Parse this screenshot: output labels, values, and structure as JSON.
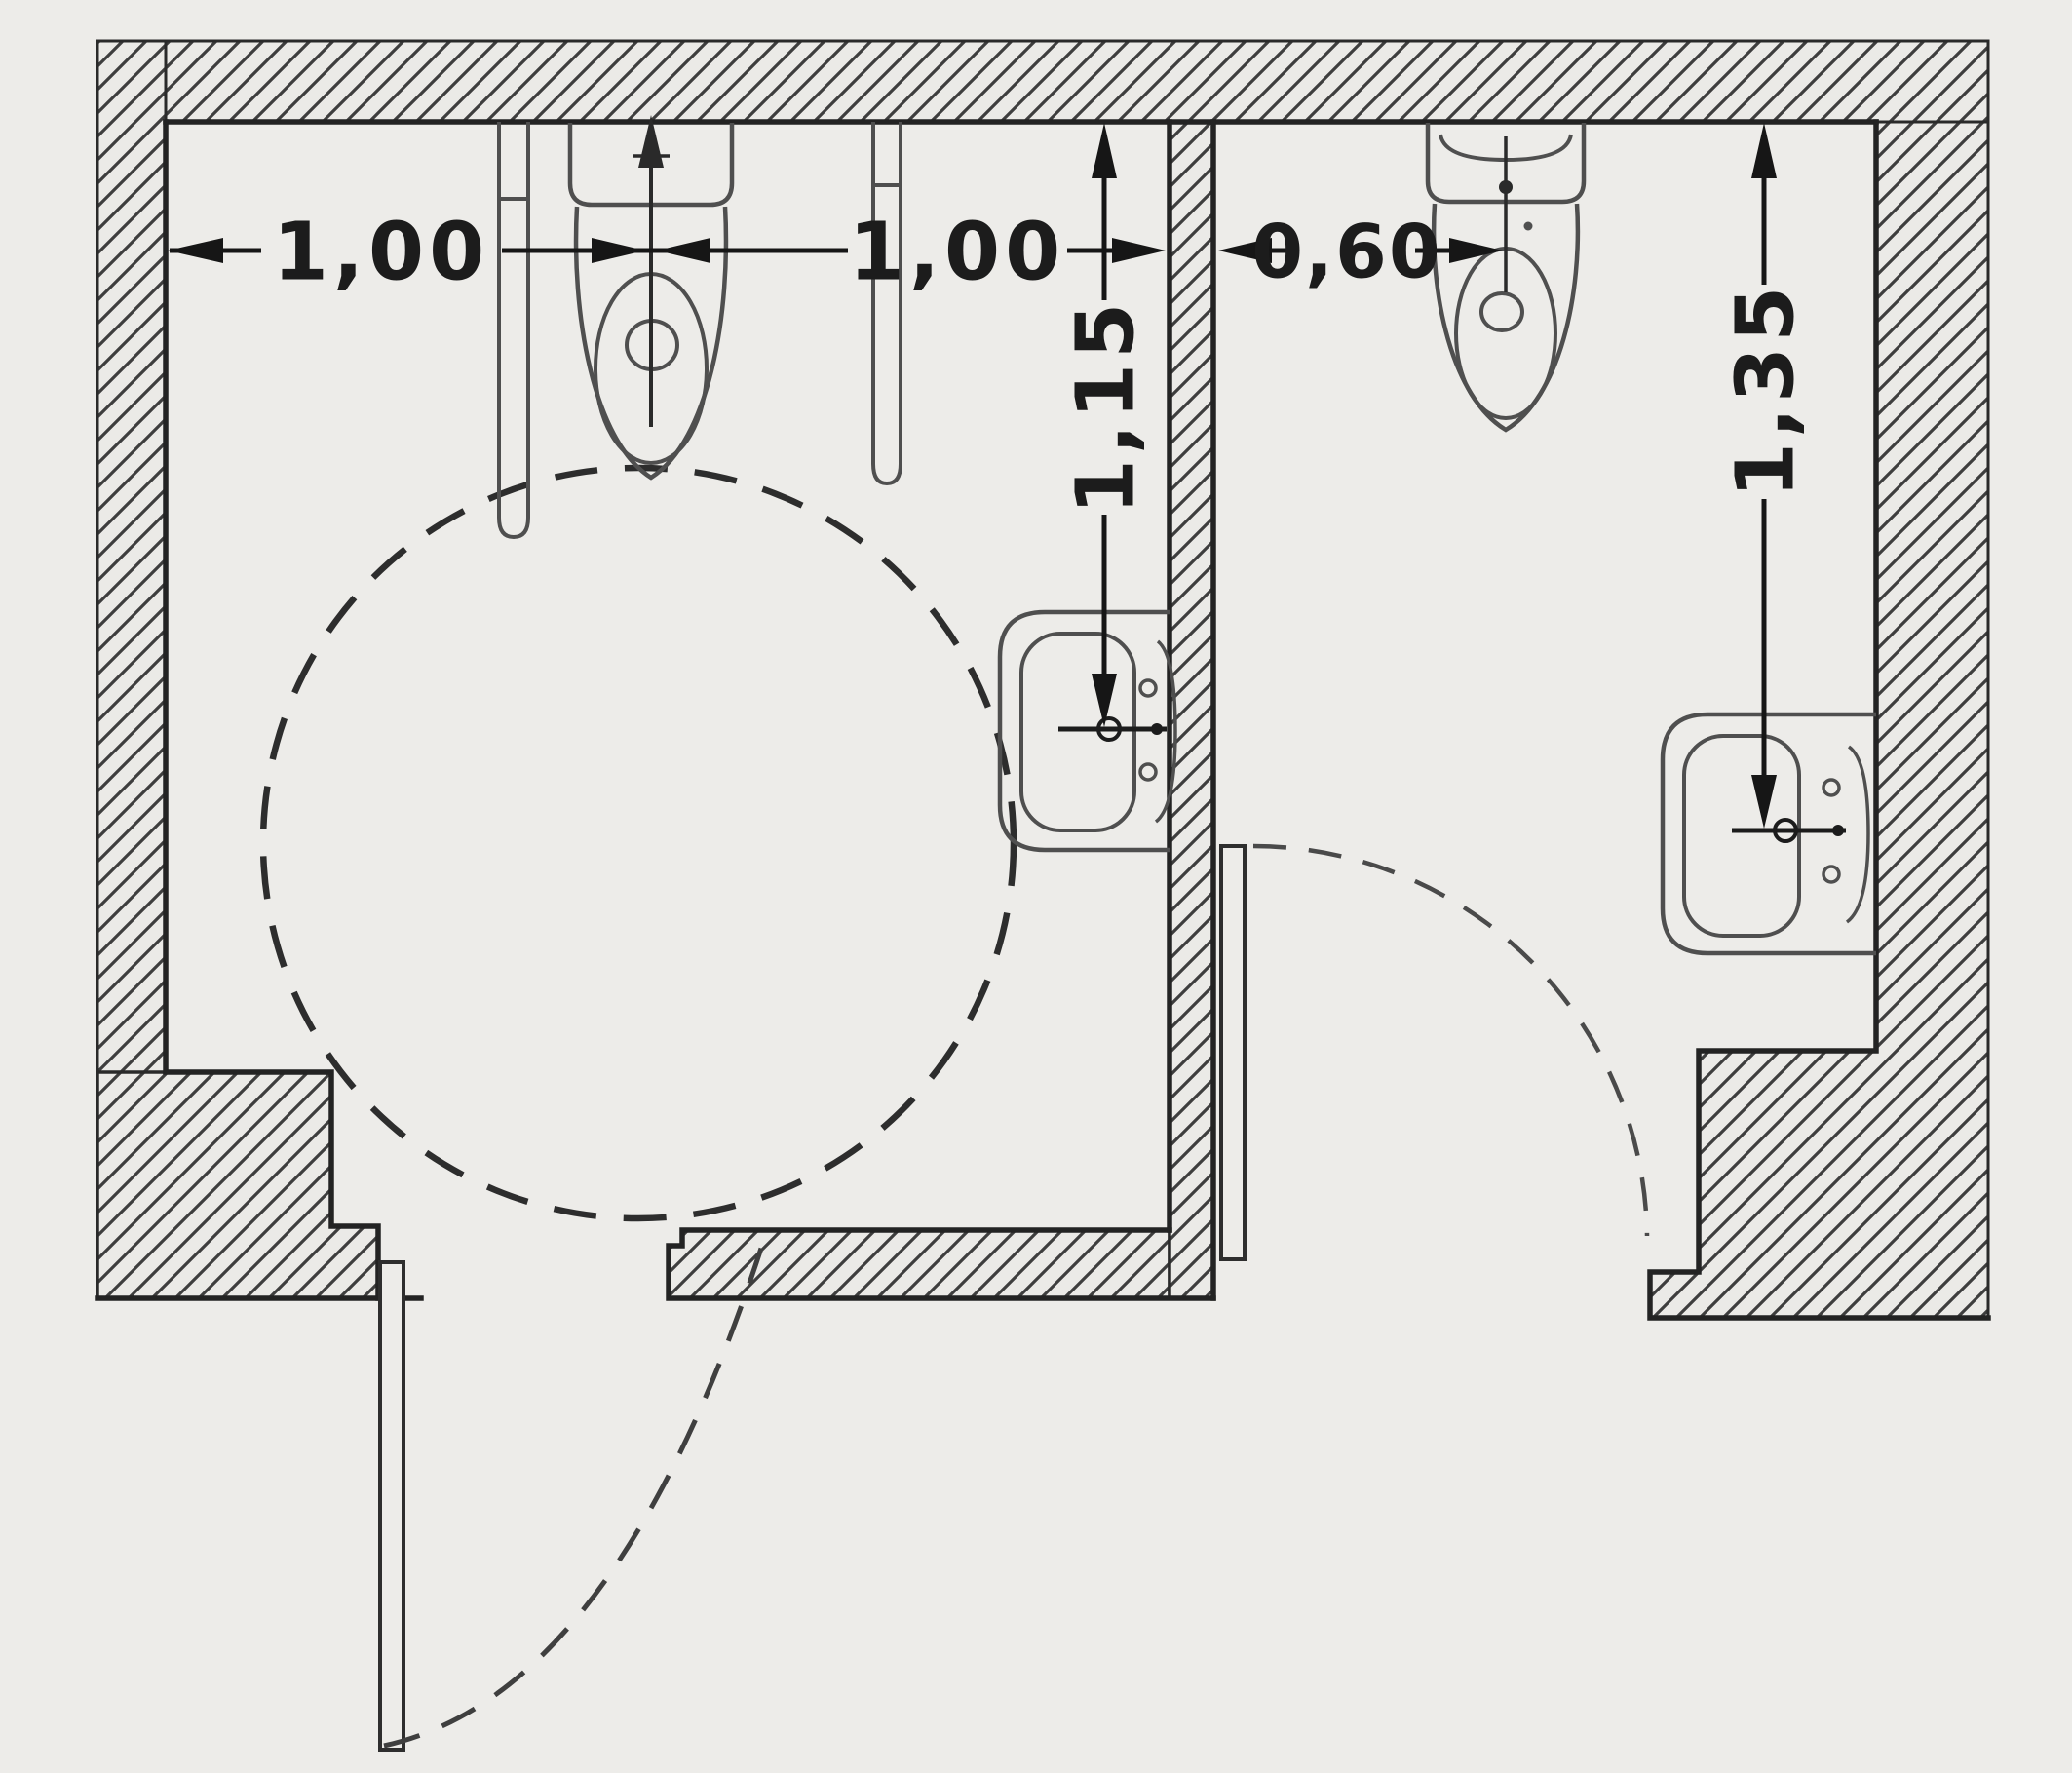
{
  "drawing": {
    "kind": "architectural-floor-plan",
    "subject": "Plan view of two WC cubicles: accessible WC with turning circle (left) and standard WC (right)",
    "units": "meters",
    "paper_color": "#edece9",
    "wall_ink_color": "#2a2a2a",
    "fixture_ink_color": "#4f4f4f",
    "dimension_ink_color": "#161616"
  },
  "accessible_wc": {
    "name": "accessible-wc-cubicle",
    "fixtures": [
      "toilet-with-cistern",
      "fold-up-grab-bar-left",
      "fold-up-grab-bar-right",
      "washbasin-on-partition-wall",
      "turning-circle-dashed",
      "outward-opening-door-with-swing-arc"
    ],
    "dimensions": {
      "wall_to_toilet_axis": {
        "label": "1,00",
        "orientation": "horizontal"
      },
      "toilet_axis_to_partition": {
        "label": "1,00",
        "orientation": "horizontal"
      },
      "rear_wall_to_washbasin_axis": {
        "label": "1,15",
        "orientation": "vertical"
      }
    }
  },
  "standard_wc": {
    "name": "standard-wc-cubicle",
    "fixtures": [
      "toilet-with-cistern",
      "washbasin-on-outer-wall",
      "inward-opening-door-with-swing-arc"
    ],
    "dimensions": {
      "partition_to_toilet_axis": {
        "label": "0,60",
        "orientation": "horizontal"
      },
      "rear_wall_to_washbasin_axis": {
        "label": "1,35",
        "orientation": "vertical"
      }
    }
  }
}
